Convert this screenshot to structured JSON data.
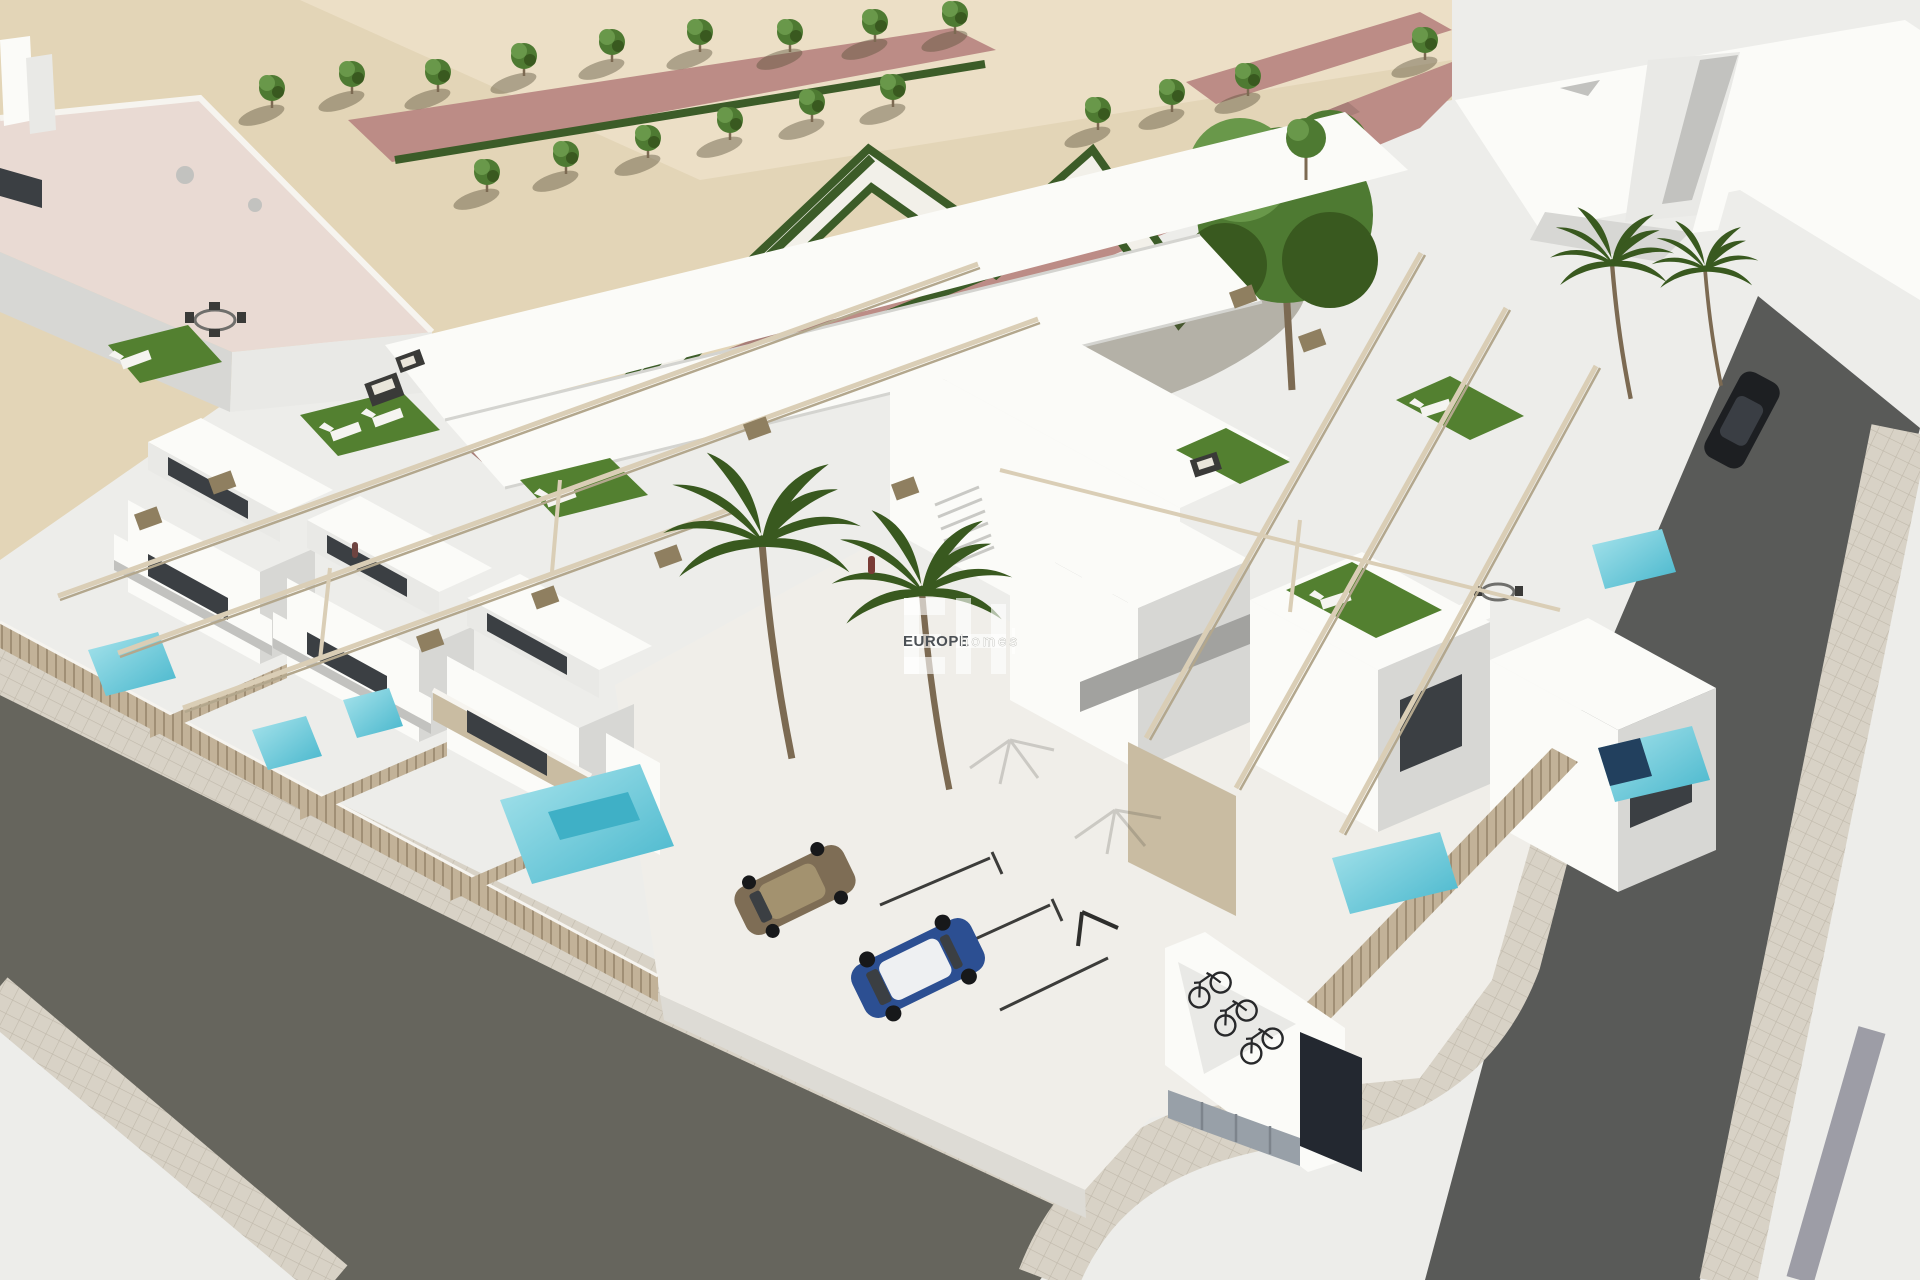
{
  "watermark": {
    "monogram": "EH",
    "brand": "EUROPE",
    "brand_suffix": "homes"
  },
  "colors": {
    "sand": "#e3d5b7",
    "sandLight": "#ecdfc6",
    "pinkPath": "#bc8c86",
    "pinkPathDark": "#a87e78",
    "walkway": "#f2f0e9",
    "hedge": "#3c5c28",
    "treeGreen": "#4e7a32",
    "treeLight": "#69984a",
    "treeDark": "#39591f",
    "trunk": "#7c6a52",
    "whiteWall": "#fbfbf8",
    "wallShade1": "#e9e9e6",
    "wallShade2": "#d7d7d4",
    "wallShade3": "#c2c2bf",
    "wallDeep": "#a2a29f",
    "roofPink": "#e9dad3",
    "windowDark": "#3b3f43",
    "glass": "#c7ccd1",
    "beigePanel": "#c9bca2",
    "fence": "#c2b298",
    "fenceDark": "#a08f75",
    "turf": "#538030",
    "turfLight": "#6aa03e",
    "poolAqua": "#7fd5e0",
    "poolDeep": "#3fb0c6",
    "poolNavy": "#22405e",
    "roadLeft": "#66655d",
    "roadRight": "#595a58",
    "paver": "#d8d2c6",
    "paverLine": "#c0b9ab",
    "courtyard": "#f0eee9",
    "courtyardShade": "#dddbd5",
    "pergola": "#daceb6",
    "pergolaDark": "#b3a78d",
    "tanBlock": "#8f7f60",
    "sofaDark": "#3a3a38",
    "cushion": "#e9e5da",
    "lounger": "#f5f4f0",
    "carBronze": "#7e6d55",
    "carBronzeLight": "#a3926f",
    "carBlue": "#2c4f92",
    "carRoofWhite": "#eef0f2",
    "tire": "#17181a",
    "bike": "#28292b",
    "cabinet": "#98a0a8",
    "navyWall": "#232830",
    "groundWhite": "#ededea",
    "stripeGray": "#9d9da6",
    "curb": "#f6f4ef",
    "wmText": "#4b5055"
  }
}
